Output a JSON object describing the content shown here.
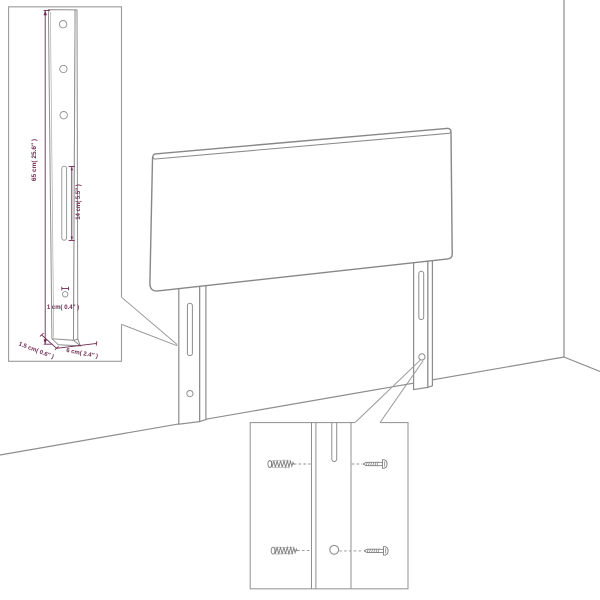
{
  "diagram": {
    "labels": {
      "leg_height": "65 cm( 25.6″ )",
      "slot_length": "14 cm( 5.5″ )",
      "hole_diameter": "1 cm( 0.4″ )",
      "leg_thickness": "1.5 cm( 0.6″ )",
      "leg_depth": "6 cm( 2.4″ )"
    },
    "colors": {
      "line_art": "#8c8c8c",
      "dimension": "#6d2a50",
      "background": "#ffffff"
    },
    "icons": {
      "left_inset": "leg-dimension-detail",
      "right_inset": "mounting-screw-detail",
      "screw_types": [
        "lag-screw-icon",
        "wood-screw-icon"
      ]
    }
  }
}
